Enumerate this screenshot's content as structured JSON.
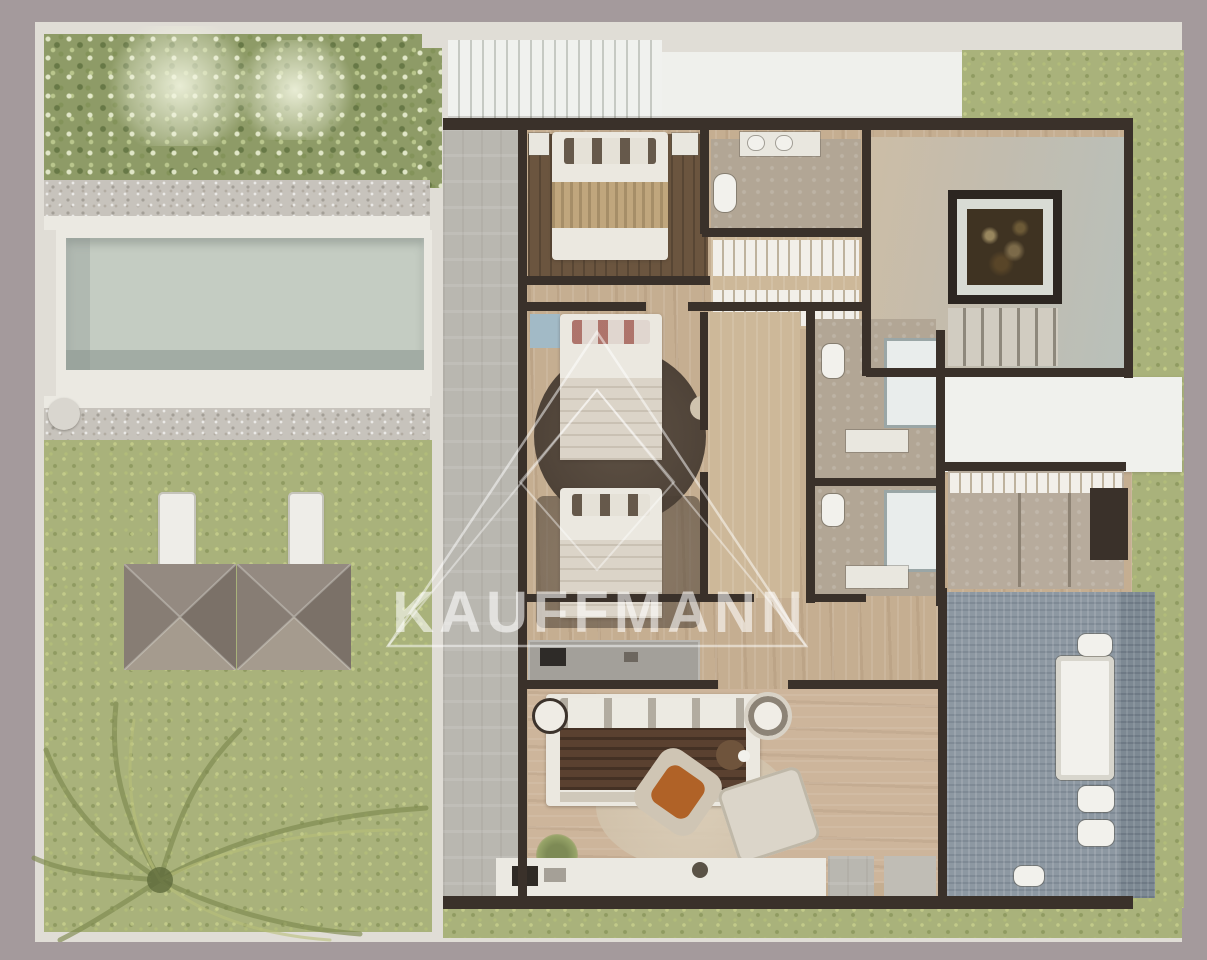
{
  "watermark": {
    "text": "KAUFFMANN"
  },
  "scene": {
    "type": "architectural-floor-plan",
    "view": "top-down-3d-render",
    "areas": [
      "garden-hedge",
      "gravel-path",
      "swimming-pool",
      "lawn",
      "sun-loungers",
      "gazebo-roofs",
      "palm-tree",
      "pergola-roof",
      "roof-deck",
      "side-terrace",
      "bedroom-1",
      "en-suite-bathroom",
      "wardrobe-hall",
      "atrium-void",
      "staircase",
      "bedroom-2",
      "bedroom-3",
      "bathroom-a",
      "bathroom-b",
      "white-landing",
      "walk-in-closet",
      "hallway",
      "master-bedroom",
      "master-bathroom",
      "mosaic-balcony",
      "rear-terrace"
    ]
  },
  "palette": {
    "border": "#a49a9c",
    "paving": "#e0ddd6",
    "walk": "#ebe9e2",
    "hedge": "#8e9b67",
    "lawn": "#a9b27b",
    "gravel": "#c7c3bc",
    "pool": "#c4ccc2",
    "pooldeep": "#a2aca4",
    "wall": "#3a312a",
    "wood": "#c5ae91",
    "woodlight": "#cdb899",
    "woodwarm": "#cdb59b",
    "wooddark": "#6b553f",
    "concrete": "#b9b7b0",
    "bedwhite": "#ebe8e0",
    "blankettan": "#c0a67d",
    "blanketbrown": "#5a4130",
    "orange": "#b06227",
    "mosaic": "#8d98a2",
    "mosaicdark": "#7d8993",
    "landing": "#f0f1ed",
    "stone": "#b2a695",
    "roofa": "#948a81",
    "roofb": "#7b7168",
    "watermark_white": "#ffffff"
  }
}
